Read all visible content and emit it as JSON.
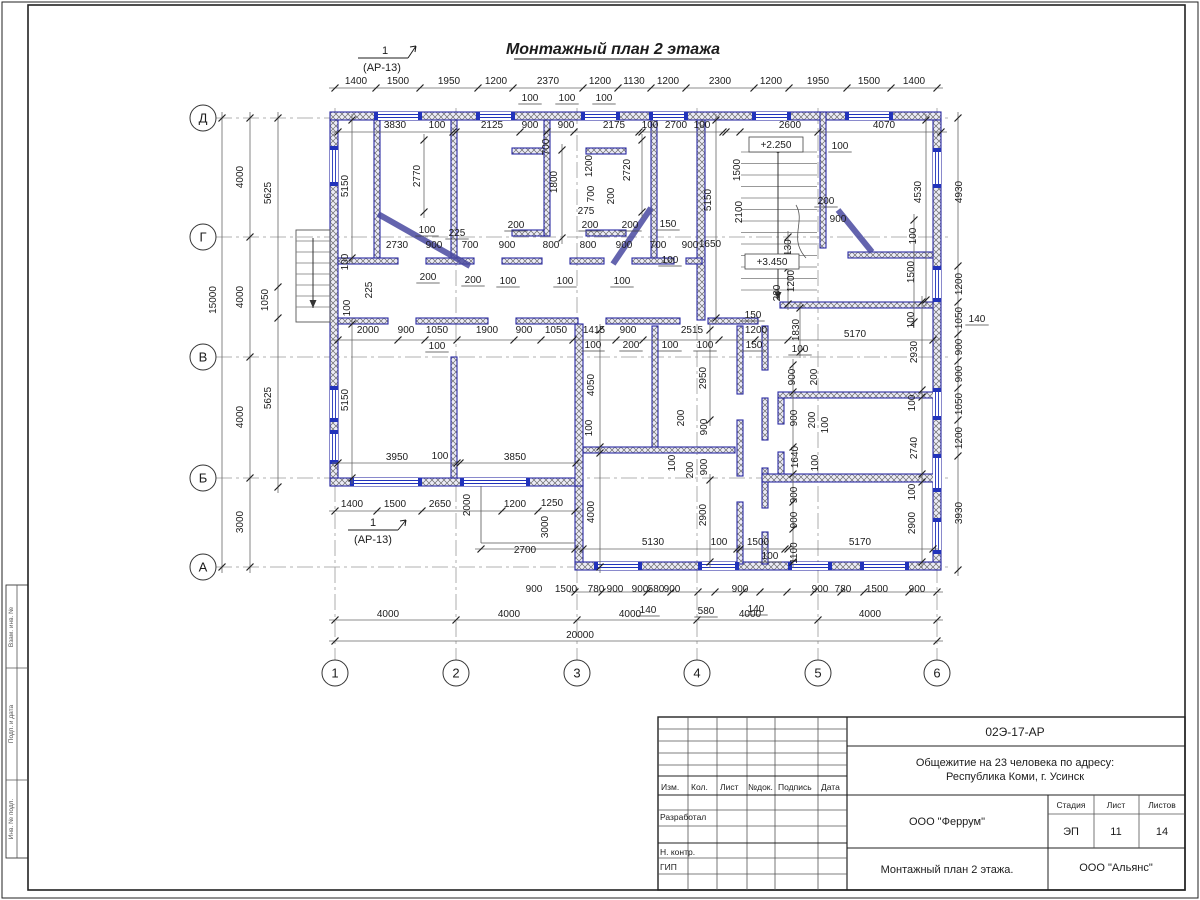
{
  "title": {
    "text": "Монтажный план 2 этажа"
  },
  "section_markers": [
    {
      "num": "1",
      "ref": "(АР-13)"
    },
    {
      "num": "1",
      "ref": "(АР-13)"
    }
  ],
  "axes": {
    "letters": [
      {
        "label": "Д",
        "y": 118
      },
      {
        "label": "Г",
        "y": 237
      },
      {
        "label": "В",
        "y": 357
      },
      {
        "label": "Б",
        "y": 478
      },
      {
        "label": "А",
        "y": 567
      }
    ],
    "numbers": [
      {
        "label": "1",
        "x": 335
      },
      {
        "label": "2",
        "x": 456
      },
      {
        "label": "3",
        "x": 577
      },
      {
        "label": "4",
        "x": 697
      },
      {
        "label": "5",
        "x": 818
      },
      {
        "label": "6",
        "x": 937
      }
    ]
  },
  "elevation_marks": [
    "+2.250",
    "+3.450"
  ],
  "plan_labels": [
    [
      "1400",
      356,
      84
    ],
    [
      "1500",
      398,
      84
    ],
    [
      "1950",
      449,
      84
    ],
    [
      "1200",
      496,
      84
    ],
    [
      "2370",
      548,
      84
    ],
    [
      "1200",
      600,
      84
    ],
    [
      "1130",
      634,
      84
    ],
    [
      "1200",
      668,
      84
    ],
    [
      "2300",
      720,
      84
    ],
    [
      "1200",
      771,
      84
    ],
    [
      "1950",
      818,
      84
    ],
    [
      "1500",
      869,
      84
    ],
    [
      "1400",
      914,
      84
    ],
    [
      "100",
      530,
      101,
      "u"
    ],
    [
      "100",
      567,
      101,
      "u"
    ],
    [
      "100",
      604,
      101,
      "u"
    ],
    [
      "3830",
      395,
      128
    ],
    [
      "100",
      437,
      128
    ],
    [
      "2125",
      492,
      128
    ],
    [
      "900",
      530,
      128
    ],
    [
      "900",
      566,
      128
    ],
    [
      "2175",
      614,
      128
    ],
    [
      "100",
      650,
      128
    ],
    [
      "2700",
      676,
      128
    ],
    [
      "100",
      702,
      128
    ],
    [
      "2600",
      790,
      128
    ],
    [
      "4070",
      884,
      128
    ],
    [
      "4000",
      243,
      177,
      "r"
    ],
    [
      "5625",
      271,
      193,
      "r"
    ],
    [
      "15000",
      216,
      300,
      "r"
    ],
    [
      "4000",
      243,
      297,
      "r"
    ],
    [
      "1050",
      268,
      300,
      "r"
    ],
    [
      "5625",
      271,
      398,
      "r"
    ],
    [
      "4000",
      243,
      417,
      "r"
    ],
    [
      "3000",
      243,
      522,
      "r"
    ],
    [
      "4930",
      962,
      192,
      "r"
    ],
    [
      "1200",
      962,
      284,
      "r"
    ],
    [
      "1050",
      962,
      318,
      "r"
    ],
    [
      "900",
      962,
      347,
      "r"
    ],
    [
      "140",
      977,
      322,
      "u"
    ],
    [
      "900",
      962,
      374,
      "r"
    ],
    [
      "1050",
      962,
      404,
      "r"
    ],
    [
      "1200",
      962,
      438,
      "r"
    ],
    [
      "3930",
      962,
      513,
      "r"
    ],
    [
      "900",
      534,
      592
    ],
    [
      "1500",
      566,
      592
    ],
    [
      "780",
      596,
      592
    ],
    [
      "900",
      615,
      592
    ],
    [
      "900",
      640,
      592
    ],
    [
      "580",
      656,
      592
    ],
    [
      "900",
      672,
      592
    ],
    [
      "900",
      740,
      592
    ],
    [
      "900",
      820,
      592
    ],
    [
      "780",
      843,
      592
    ],
    [
      "1500",
      877,
      592
    ],
    [
      "900",
      917,
      592
    ],
    [
      "140",
      648,
      613,
      "u"
    ],
    [
      "580",
      706,
      614,
      "u"
    ],
    [
      "140",
      756,
      612,
      "u"
    ],
    [
      "4000",
      388,
      617
    ],
    [
      "4000",
      509,
      617
    ],
    [
      "4000",
      630,
      617
    ],
    [
      "4000",
      750,
      617
    ],
    [
      "4000",
      870,
      617
    ],
    [
      "20000",
      580,
      638
    ],
    [
      "5150",
      348,
      186,
      "r"
    ],
    [
      "2770",
      420,
      176,
      "r"
    ],
    [
      "700",
      549,
      147,
      "r"
    ],
    [
      "1800",
      557,
      182,
      "r"
    ],
    [
      "1200",
      592,
      166,
      "r"
    ],
    [
      "700",
      594,
      194,
      "r"
    ],
    [
      "200",
      614,
      196,
      "r"
    ],
    [
      "275",
      586,
      214
    ],
    [
      "2720",
      630,
      170,
      "r"
    ],
    [
      "5150",
      711,
      200,
      "r"
    ],
    [
      "1500",
      740,
      170,
      "r"
    ],
    [
      "2100",
      742,
      212,
      "r"
    ],
    [
      "+2.250",
      776,
      148,
      "b"
    ],
    [
      "100",
      840,
      149,
      "u"
    ],
    [
      "4530",
      921,
      192,
      "r"
    ],
    [
      "200",
      826,
      204,
      "u"
    ],
    [
      "900",
      838,
      222
    ],
    [
      "1130",
      791,
      250,
      "r"
    ],
    [
      "1200",
      794,
      281,
      "r"
    ],
    [
      "200",
      780,
      293,
      "r"
    ],
    [
      "+3.450",
      772,
      265,
      "b"
    ],
    [
      "2730",
      397,
      248
    ],
    [
      "900",
      434,
      248
    ],
    [
      "700",
      470,
      248
    ],
    [
      "900",
      507,
      248
    ],
    [
      "800",
      551,
      248
    ],
    [
      "800",
      588,
      248
    ],
    [
      "900",
      624,
      248
    ],
    [
      "700",
      658,
      248
    ],
    [
      "900",
      690,
      248
    ],
    [
      "1650",
      710,
      247
    ],
    [
      "100",
      427,
      233,
      "u"
    ],
    [
      "225",
      457,
      236,
      "u"
    ],
    [
      "200",
      516,
      228,
      "u"
    ],
    [
      "200",
      590,
      228,
      "u"
    ],
    [
      "200",
      630,
      228,
      "u"
    ],
    [
      "150",
      668,
      227,
      "u"
    ],
    [
      "200",
      428,
      280,
      "u"
    ],
    [
      "200",
      473,
      283,
      "u"
    ],
    [
      "100",
      508,
      284,
      "u"
    ],
    [
      "100",
      565,
      284,
      "u"
    ],
    [
      "100",
      622,
      284,
      "u"
    ],
    [
      "100",
      670,
      263,
      "u"
    ],
    [
      "225",
      372,
      290,
      "r"
    ],
    [
      "100",
      348,
      262,
      "r"
    ],
    [
      "2000",
      368,
      333
    ],
    [
      "900",
      406,
      333
    ],
    [
      "1050",
      437,
      333
    ],
    [
      "1900",
      487,
      333
    ],
    [
      "900",
      524,
      333
    ],
    [
      "1050",
      556,
      333
    ],
    [
      "1415",
      594,
      333
    ],
    [
      "900",
      628,
      333
    ],
    [
      "2515",
      692,
      333
    ],
    [
      "100",
      437,
      349,
      "u"
    ],
    [
      "100",
      593,
      348,
      "u"
    ],
    [
      "200",
      631,
      348,
      "u"
    ],
    [
      "100",
      670,
      348,
      "u"
    ],
    [
      "100",
      705,
      348,
      "u"
    ],
    [
      "150",
      753,
      318,
      "u"
    ],
    [
      "1200",
      756,
      333
    ],
    [
      "150",
      754,
      348,
      "u"
    ],
    [
      "100",
      350,
      308,
      "r"
    ],
    [
      "1830",
      799,
      330,
      "r"
    ],
    [
      "5170",
      855,
      337
    ],
    [
      "100",
      800,
      352,
      "u"
    ],
    [
      "2930",
      917,
      352,
      "r"
    ],
    [
      "100",
      916,
      236,
      "r"
    ],
    [
      "1500",
      914,
      272,
      "r"
    ],
    [
      "100",
      914,
      320,
      "r"
    ],
    [
      "900",
      795,
      377,
      "r"
    ],
    [
      "200",
      817,
      377,
      "r"
    ],
    [
      "5150",
      348,
      400,
      "r"
    ],
    [
      "4050",
      594,
      385,
      "r"
    ],
    [
      "100",
      592,
      428,
      "r"
    ],
    [
      "2950",
      706,
      378,
      "r"
    ],
    [
      "200",
      684,
      418,
      "r"
    ],
    [
      "900",
      707,
      427,
      "r"
    ],
    [
      "100",
      675,
      463,
      "r"
    ],
    [
      "200",
      693,
      470,
      "r"
    ],
    [
      "900",
      707,
      467,
      "r"
    ],
    [
      "4000",
      594,
      512,
      "r"
    ],
    [
      "2900",
      706,
      515,
      "r"
    ],
    [
      "3950",
      397,
      460
    ],
    [
      "100",
      440,
      459
    ],
    [
      "3850",
      515,
      460
    ],
    [
      "1400",
      352,
      507
    ],
    [
      "1500",
      395,
      507
    ],
    [
      "2650",
      440,
      507
    ],
    [
      "1200",
      515,
      507
    ],
    [
      "1250",
      552,
      506
    ],
    [
      "2000",
      470,
      505,
      "r"
    ],
    [
      "3000",
      548,
      527,
      "r"
    ],
    [
      "2700",
      525,
      553
    ],
    [
      "5130",
      653,
      545
    ],
    [
      "100",
      719,
      545
    ],
    [
      "1500",
      758,
      545
    ],
    [
      "100",
      770,
      559,
      "u"
    ],
    [
      "5170",
      860,
      545
    ],
    [
      "900",
      797,
      418,
      "r"
    ],
    [
      "200",
      815,
      420,
      "r"
    ],
    [
      "100",
      828,
      425,
      "r"
    ],
    [
      "1640",
      798,
      457,
      "r"
    ],
    [
      "100",
      818,
      463,
      "r"
    ],
    [
      "900",
      797,
      495,
      "r"
    ],
    [
      "900",
      797,
      520,
      "r"
    ],
    [
      "1100",
      797,
      553,
      "r"
    ],
    [
      "100",
      915,
      403,
      "r"
    ],
    [
      "2740",
      917,
      448,
      "r"
    ],
    [
      "100",
      915,
      492,
      "r"
    ],
    [
      "2900",
      915,
      523,
      "r"
    ]
  ],
  "titleblock": {
    "code": "02Э-17-АР",
    "project_line1": "Общежитие на 23 человека по адресу:",
    "project_line2": "Республика Коми, г. Усинск",
    "designer_org": "ООО \"Феррум\"",
    "customer_org": "ООО \"Альянс\"",
    "drawing_title": "Монтажный план 2 этажа.",
    "stage_label": "Стадия",
    "sheet_label": "Лист",
    "sheets_label": "Листов",
    "stage": "ЭП",
    "sheet": "11",
    "sheets": "14",
    "cols": {
      "izm": "Изм.",
      "kol": "Кол.",
      "list": "Лист",
      "ndok": "№док.",
      "podpis": "Подпись",
      "data": "Дата"
    },
    "rows": {
      "razrabotal": "Разработал",
      "nkontr": "Н. контр.",
      "gip": "ГИП"
    }
  },
  "frame_side_labels": [
    "Взам. инв. №",
    "Подп. и дата",
    "Инв. № подл."
  ],
  "colors": {
    "wall_stroke": "#2929a3",
    "wall_fill": "#ececf6",
    "hatch": "#6b6b6b",
    "dim_line": "#666666",
    "window": "#2233bb"
  }
}
